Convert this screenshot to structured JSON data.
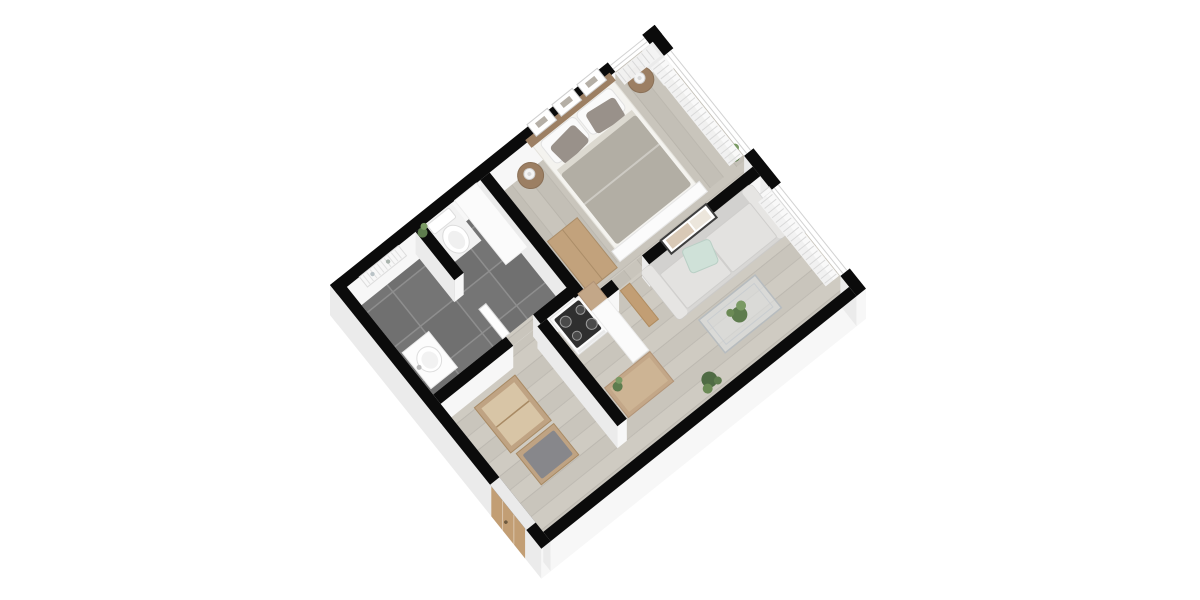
{
  "scene": {
    "type": "3d-isometric-floor-plan-render",
    "aria_label": "3D isometric floor plan render of a one-bedroom apartment with bedroom, living room, bathroom, kitchen nook and hallway",
    "background": "#ffffff",
    "rotation_deg": -38.7
  },
  "rooms": [
    {
      "id": "bedroom",
      "name": "Bedroom",
      "floor": "light-wood-planks",
      "furniture": [
        "double-bed",
        "wood-headboard",
        "white-pillows",
        "gray-accent-pillows",
        "gray-duvet",
        "foot-bench",
        "nightstand-left",
        "nightstand-right",
        "table-lamps",
        "three-wall-pictures",
        "dresser",
        "corner-plant",
        "window-curtains"
      ]
    },
    {
      "id": "living-room",
      "name": "Living room",
      "floor": "light-wood-planks",
      "furniture": [
        "sofa",
        "mint-cushion",
        "framed-wall-picture",
        "glass-coffee-table",
        "table-plant",
        "floor-plant",
        "radiator",
        "open-wood-door",
        "window-curtains"
      ]
    },
    {
      "id": "bathroom",
      "name": "Bathroom",
      "floor": "dark-gray-tiles",
      "furniture": [
        "toilet",
        "washbasin-cabinet",
        "towel-radiator",
        "partition-stub-wall",
        "storage-column",
        "small-plant",
        "door-panel"
      ]
    },
    {
      "id": "kitchen",
      "name": "Kitchen nook",
      "floor": "light-wood-planks",
      "furniture": [
        "stove-with-black-cooktop",
        "wood-counter",
        "tall-white-cabinet",
        "lower-cabinet",
        "small-plant"
      ]
    },
    {
      "id": "hallway",
      "name": "Hallway",
      "floor": "light-wood-planks",
      "furniture": [
        "open-wardrobe",
        "bench",
        "gray-seat-cushion",
        "wooden-entrance-door"
      ]
    }
  ],
  "counts": {
    "windows": 3,
    "wall_pictures": 3,
    "bed_pillows": 4,
    "stove_burners": 4
  },
  "palette": {
    "wall_top": "#0b0b0b",
    "wall_face": "#f7f7f7",
    "wall_face_shaded": "#ebebeb",
    "wood_floor_a": "#c9c5bc",
    "wood_floor_a2": "#c3bfb6",
    "wood_floor_b": "#cfcbc2",
    "wood_floor_b2": "#c9c5bc",
    "plank_line": "#b0aca3",
    "tile_dark": "#757575",
    "tile_dark2": "#707070",
    "tile_grout": "#8e8e8e",
    "wood_head": "#9c7f63",
    "wood_furniture": "#c2a27c",
    "wood_kitchen": "#c3a788",
    "wood_hall": "#bfa383",
    "wood_hall_in": "#d8c5a6",
    "door_wood": "#c29e74",
    "sheet": "#f4f3ef",
    "duvet": "#b2aea4",
    "pillow_dark": "#99918а",
    "sofa": "#d8d7d5",
    "sofa_seat": "#e3e2e0",
    "sofa_arm": "#e6e5e3",
    "mint": "#cfe1d8",
    "plant": "#5e7c4e",
    "plant_light": "#7a9a64",
    "plant_dark": "#4f6b44",
    "white_furniture": "#fbfbfb",
    "outline": "#dcdcdc",
    "glass": "rgba(228,232,234,0.55)",
    "glass_edge": "#b7bcbf",
    "cooktop": "#2f2f2f",
    "curtain": "#f2f2f2",
    "curtain_line": "#d9d9d9",
    "cushion_gray": "#87878b"
  }
}
